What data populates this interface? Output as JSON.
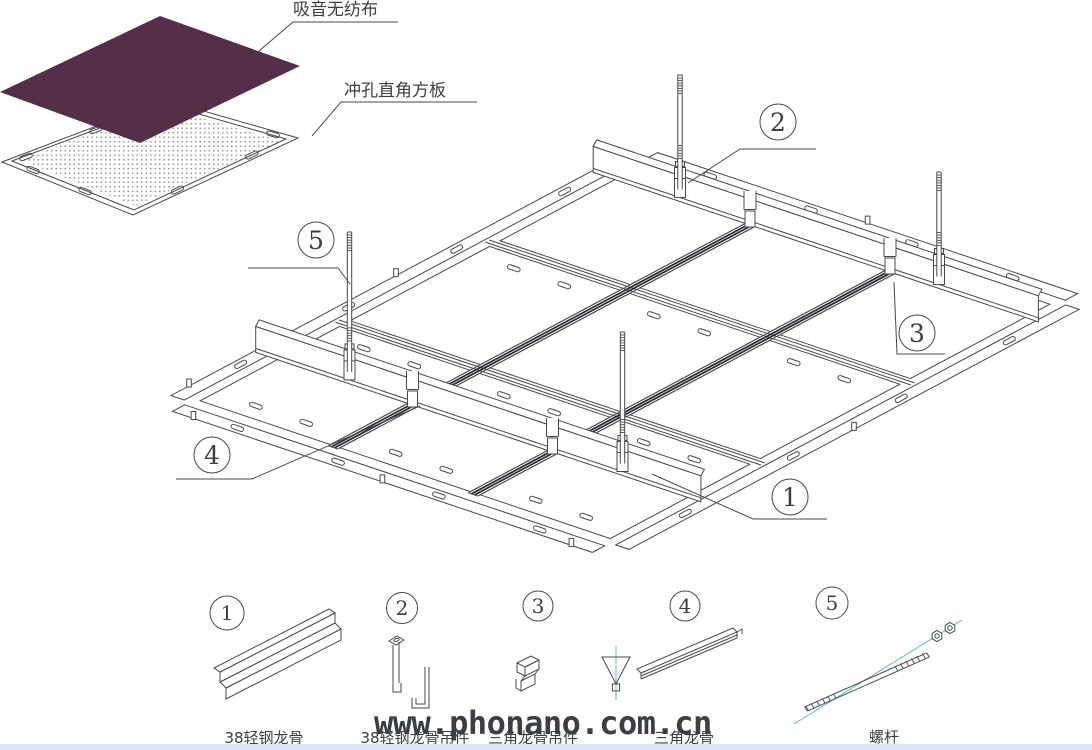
{
  "drawing": {
    "title_labels": {
      "fabric": "吸音无纺布",
      "panel": "冲孔直角方板"
    },
    "watermark": "www.phonano.com.cn",
    "parts": [
      {
        "num": "1",
        "label": "38轻钢龙骨"
      },
      {
        "num": "2",
        "label": "38轻钢龙骨吊件"
      },
      {
        "num": "3",
        "label": "三角龙骨吊件"
      },
      {
        "num": "4",
        "label": "三角龙骨"
      },
      {
        "num": "5",
        "label": "螺杆"
      }
    ],
    "colors": {
      "fabric_fill": "#543048",
      "line": "#45494d",
      "centerline": "#5ab4b4",
      "bottom_bar": "#dbe9f6",
      "watermark": "#000000"
    }
  }
}
